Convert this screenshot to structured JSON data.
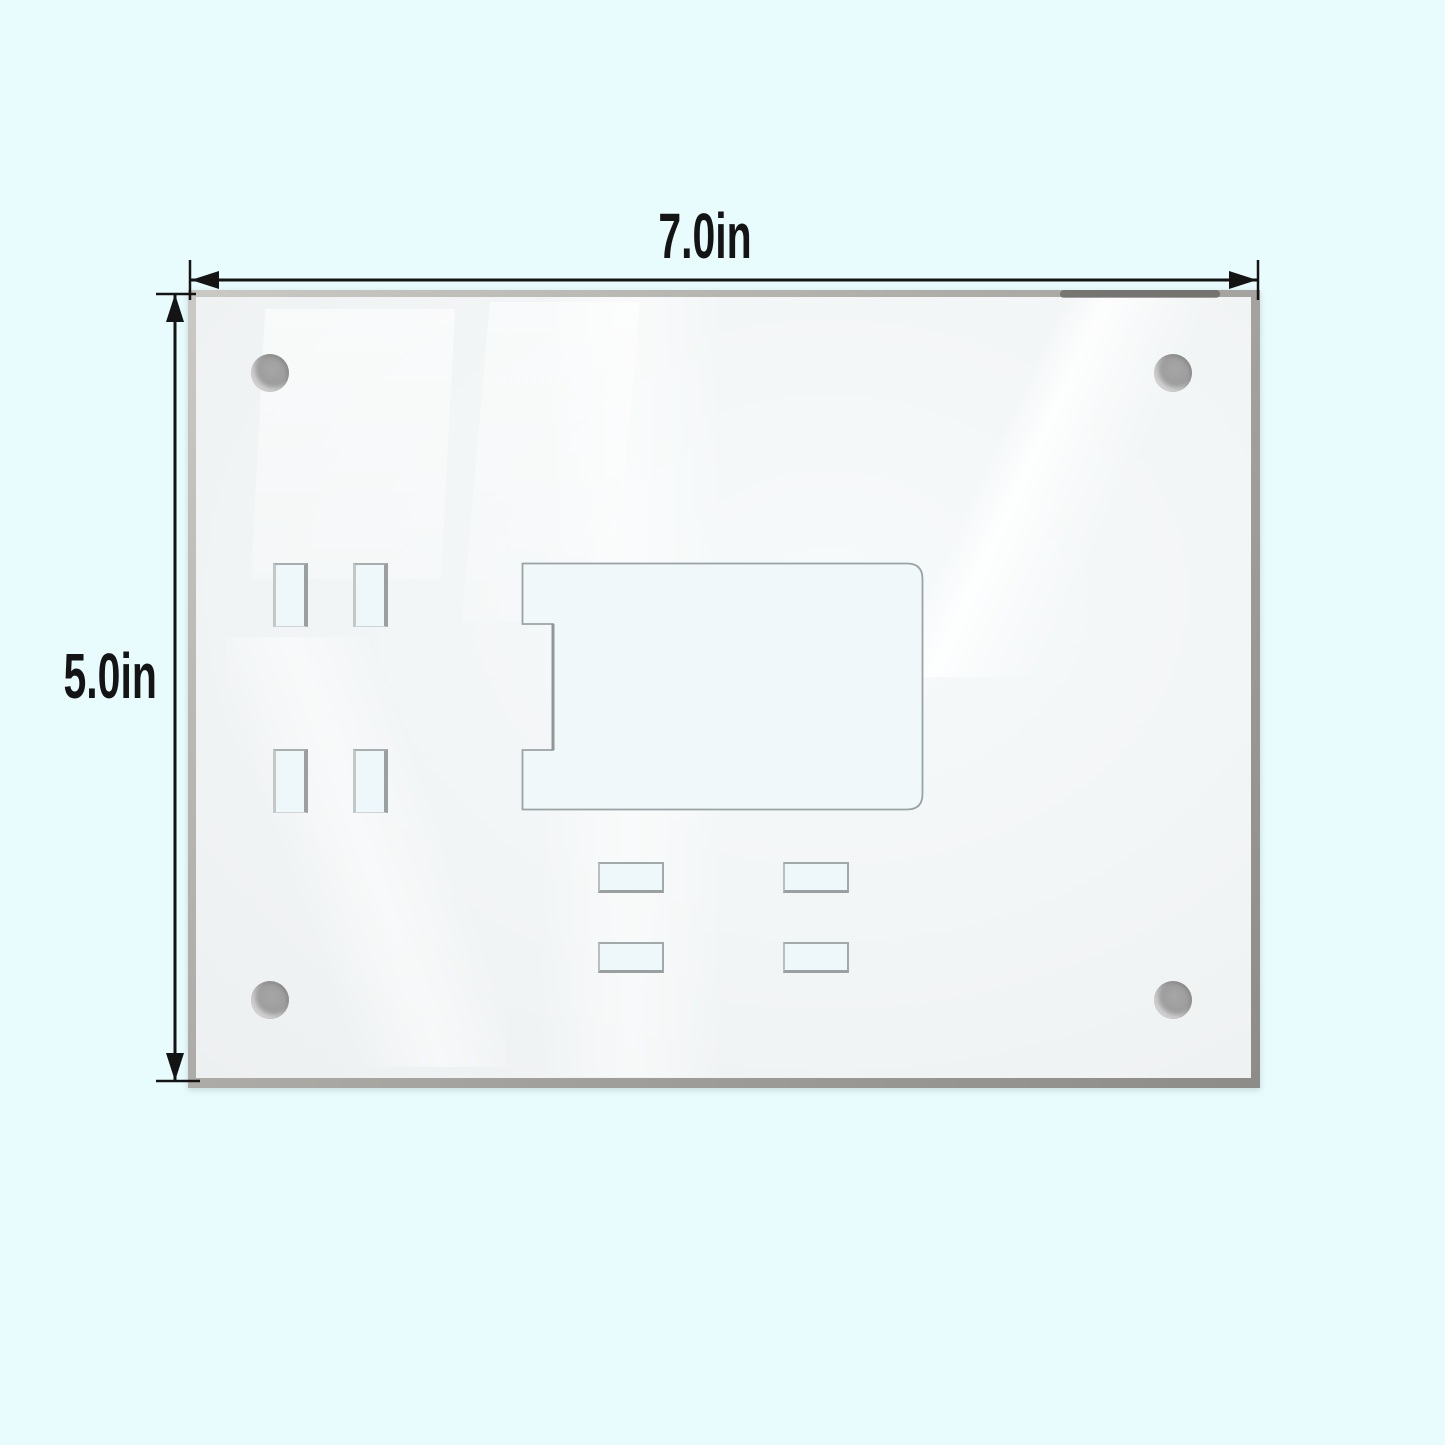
{
  "diagram": {
    "type": "product-dimension-diagram",
    "subject": "clear acrylic magnetic sign holder back panel",
    "dimensions": {
      "width_label": "7.0in",
      "height_label": "5.0in"
    },
    "features": {
      "corner_magnets": 4,
      "vertical_slots": 4,
      "horizontal_slots": 4,
      "card_cutouts": 1
    },
    "icons": {
      "magnet_dot": "gray filled circle",
      "arrow_left_icon": "◀",
      "arrow_right_icon": "▶",
      "arrow_up_icon": "▲",
      "arrow_down_icon": "▼"
    }
  },
  "colors": {
    "background": "#e8fcfd",
    "plate": "#f2f5f6",
    "plate_edge": "#a3a19d",
    "cutout_fill": "#eef8fa",
    "cutout_stroke": "#9aa3a4",
    "magnet": "#9a9a9a",
    "annotation": "#141414"
  }
}
